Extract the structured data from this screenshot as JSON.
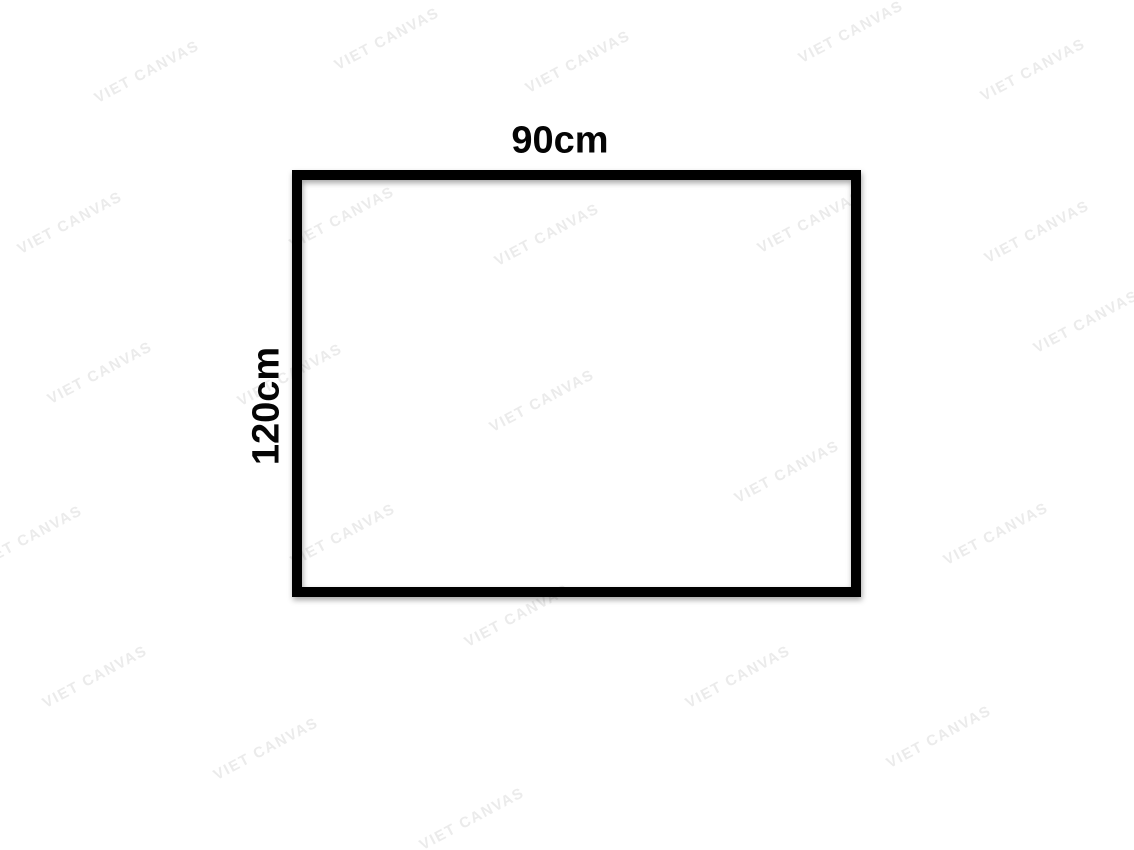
{
  "diagram": {
    "width_label": "90cm",
    "height_label": "120cm",
    "border_color": "#000000",
    "background_color": "#ffffff"
  },
  "watermark": {
    "text": "VIET CANVAS",
    "color": "#ebebeb",
    "angle_deg": -28,
    "positions": [
      [
        147,
        72
      ],
      [
        387,
        39
      ],
      [
        578,
        62
      ],
      [
        851,
        32
      ],
      [
        1033,
        70
      ],
      [
        70,
        223
      ],
      [
        342,
        218
      ],
      [
        547,
        235
      ],
      [
        810,
        222
      ],
      [
        1037,
        232
      ],
      [
        100,
        373
      ],
      [
        290,
        375
      ],
      [
        542,
        401
      ],
      [
        1086,
        322
      ],
      [
        30,
        537
      ],
      [
        343,
        535
      ],
      [
        787,
        472
      ],
      [
        996,
        534
      ],
      [
        95,
        677
      ],
      [
        517,
        616
      ],
      [
        738,
        677
      ],
      [
        266,
        749
      ],
      [
        472,
        819
      ],
      [
        939,
        737
      ]
    ]
  }
}
